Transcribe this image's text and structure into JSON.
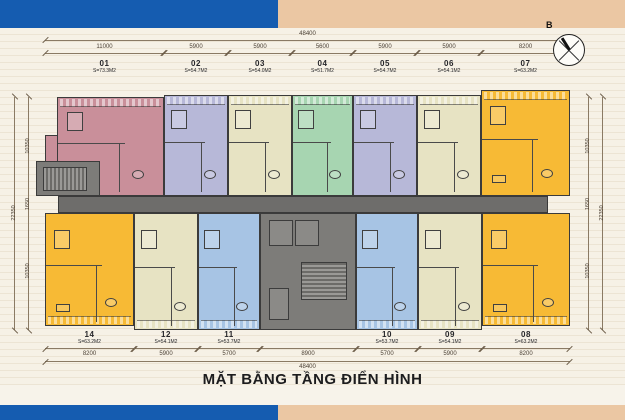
{
  "title": "MẶT BẰNG TẦNG ĐIỂN HÌNH",
  "compass": {
    "north_label": "B"
  },
  "colors": {
    "band_blue": "#155cb0",
    "band_peach": "#ebc7a3",
    "corridor_gray": "#6e6d6b",
    "core_gray": "#7d7c79",
    "pink": "#c98f9a",
    "lavender": "#b7b8d8",
    "cream": "#e7e3c3",
    "green": "#a7d5b1",
    "orange": "#f7ba35",
    "blue": "#a7c4e4"
  },
  "dimensions": {
    "top_total": "48400",
    "top_segments": [
      "11000",
      "5900",
      "5900",
      "5600",
      "5900",
      "5900",
      "8200"
    ],
    "bottom_segments": [
      "8200",
      "5900",
      "5700",
      "8900",
      "5700",
      "5900",
      "8200"
    ],
    "bottom_total": "48400",
    "left_segments": [
      "10350",
      "1650",
      "10350"
    ],
    "left_total": "22350",
    "right_segments": [
      "10350",
      "1650",
      "10350"
    ],
    "right_total": "22350"
  },
  "units_top": [
    {
      "id": "01",
      "area": "S=73.3M2",
      "color": "#c98f9a"
    },
    {
      "id": "02",
      "area": "S=54.7M2",
      "color": "#b7b8d8"
    },
    {
      "id": "03",
      "area": "S=54.0M2",
      "color": "#e7e3c3"
    },
    {
      "id": "04",
      "area": "S=51.7M2",
      "color": "#a7d5b1"
    },
    {
      "id": "05",
      "area": "S=54.7M2",
      "color": "#b7b8d8"
    },
    {
      "id": "06",
      "area": "S=54.1M2",
      "color": "#e7e3c3"
    },
    {
      "id": "07",
      "area": "S=63.2M2",
      "color": "#f7ba35"
    }
  ],
  "units_bottom": [
    {
      "id": "14",
      "area": "S=63.2M2",
      "color": "#f7ba35"
    },
    {
      "id": "12",
      "area": "S=54.1M2",
      "color": "#e7e3c3"
    },
    {
      "id": "11",
      "area": "S=53.7M2",
      "color": "#a7c4e4"
    },
    {
      "id": "10",
      "area": "S=53.7M2",
      "color": "#a7c4e4"
    },
    {
      "id": "09",
      "area": "S=54.1M2",
      "color": "#e7e3c3"
    },
    {
      "id": "08",
      "area": "S=63.2M2",
      "color": "#f7ba35"
    }
  ]
}
